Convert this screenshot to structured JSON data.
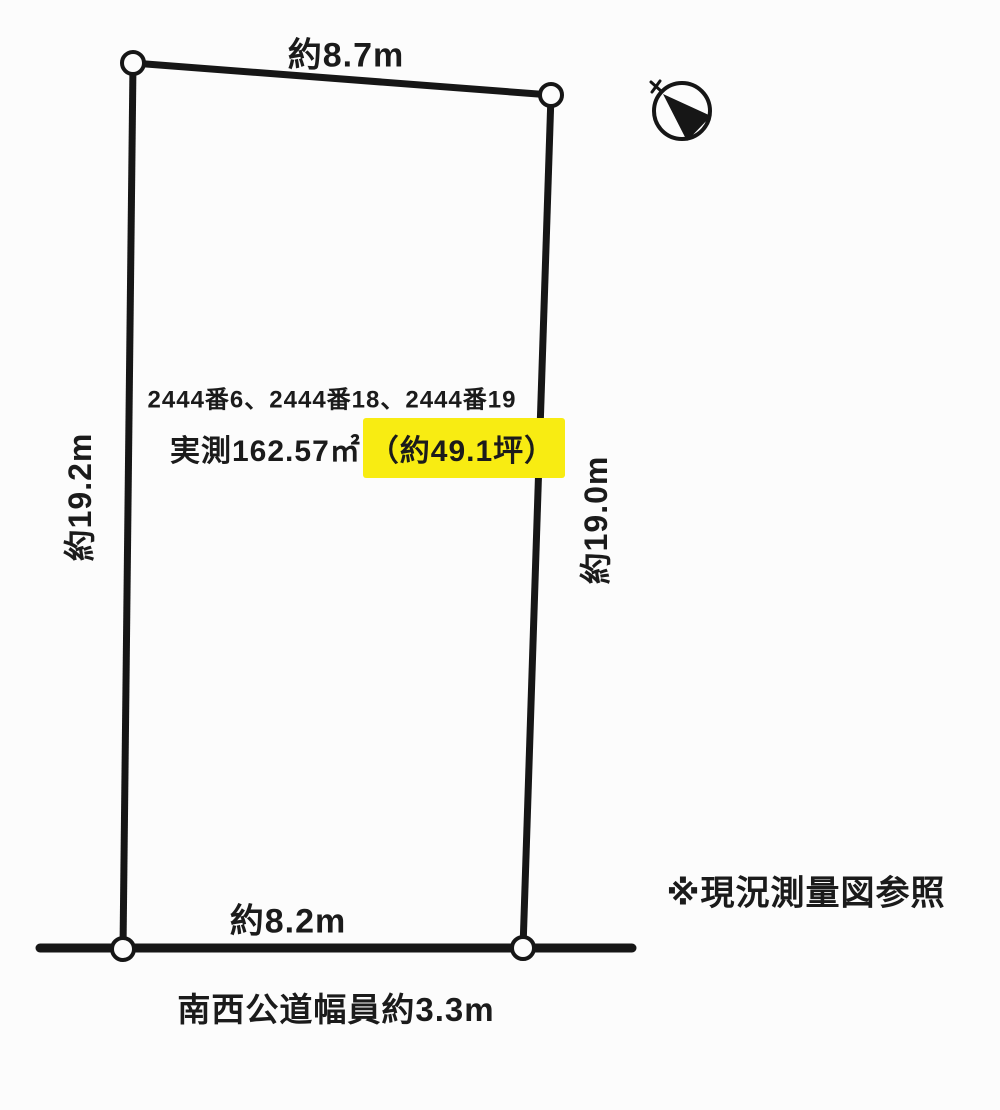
{
  "page": {
    "background": "#fcfcfc"
  },
  "diagram": {
    "dimensions": {
      "top": "約8.7m",
      "bottom": "約8.2m",
      "left": "約19.2m",
      "right": "約19.0m"
    },
    "parcel_numbers": "2444番6、2444番18、2444番19",
    "area": {
      "measured": "実測162.57㎡",
      "tsubo_highlighted": "（約49.1坪）",
      "highlight_color": "#f8ec12"
    },
    "survey_note": "※現況測量図参照",
    "road_label": "南西公道幅員約3.3m",
    "colors": {
      "line": "#161616",
      "text": "#1b1b1b"
    },
    "icons": {
      "compass": "north-compass-icon"
    }
  }
}
